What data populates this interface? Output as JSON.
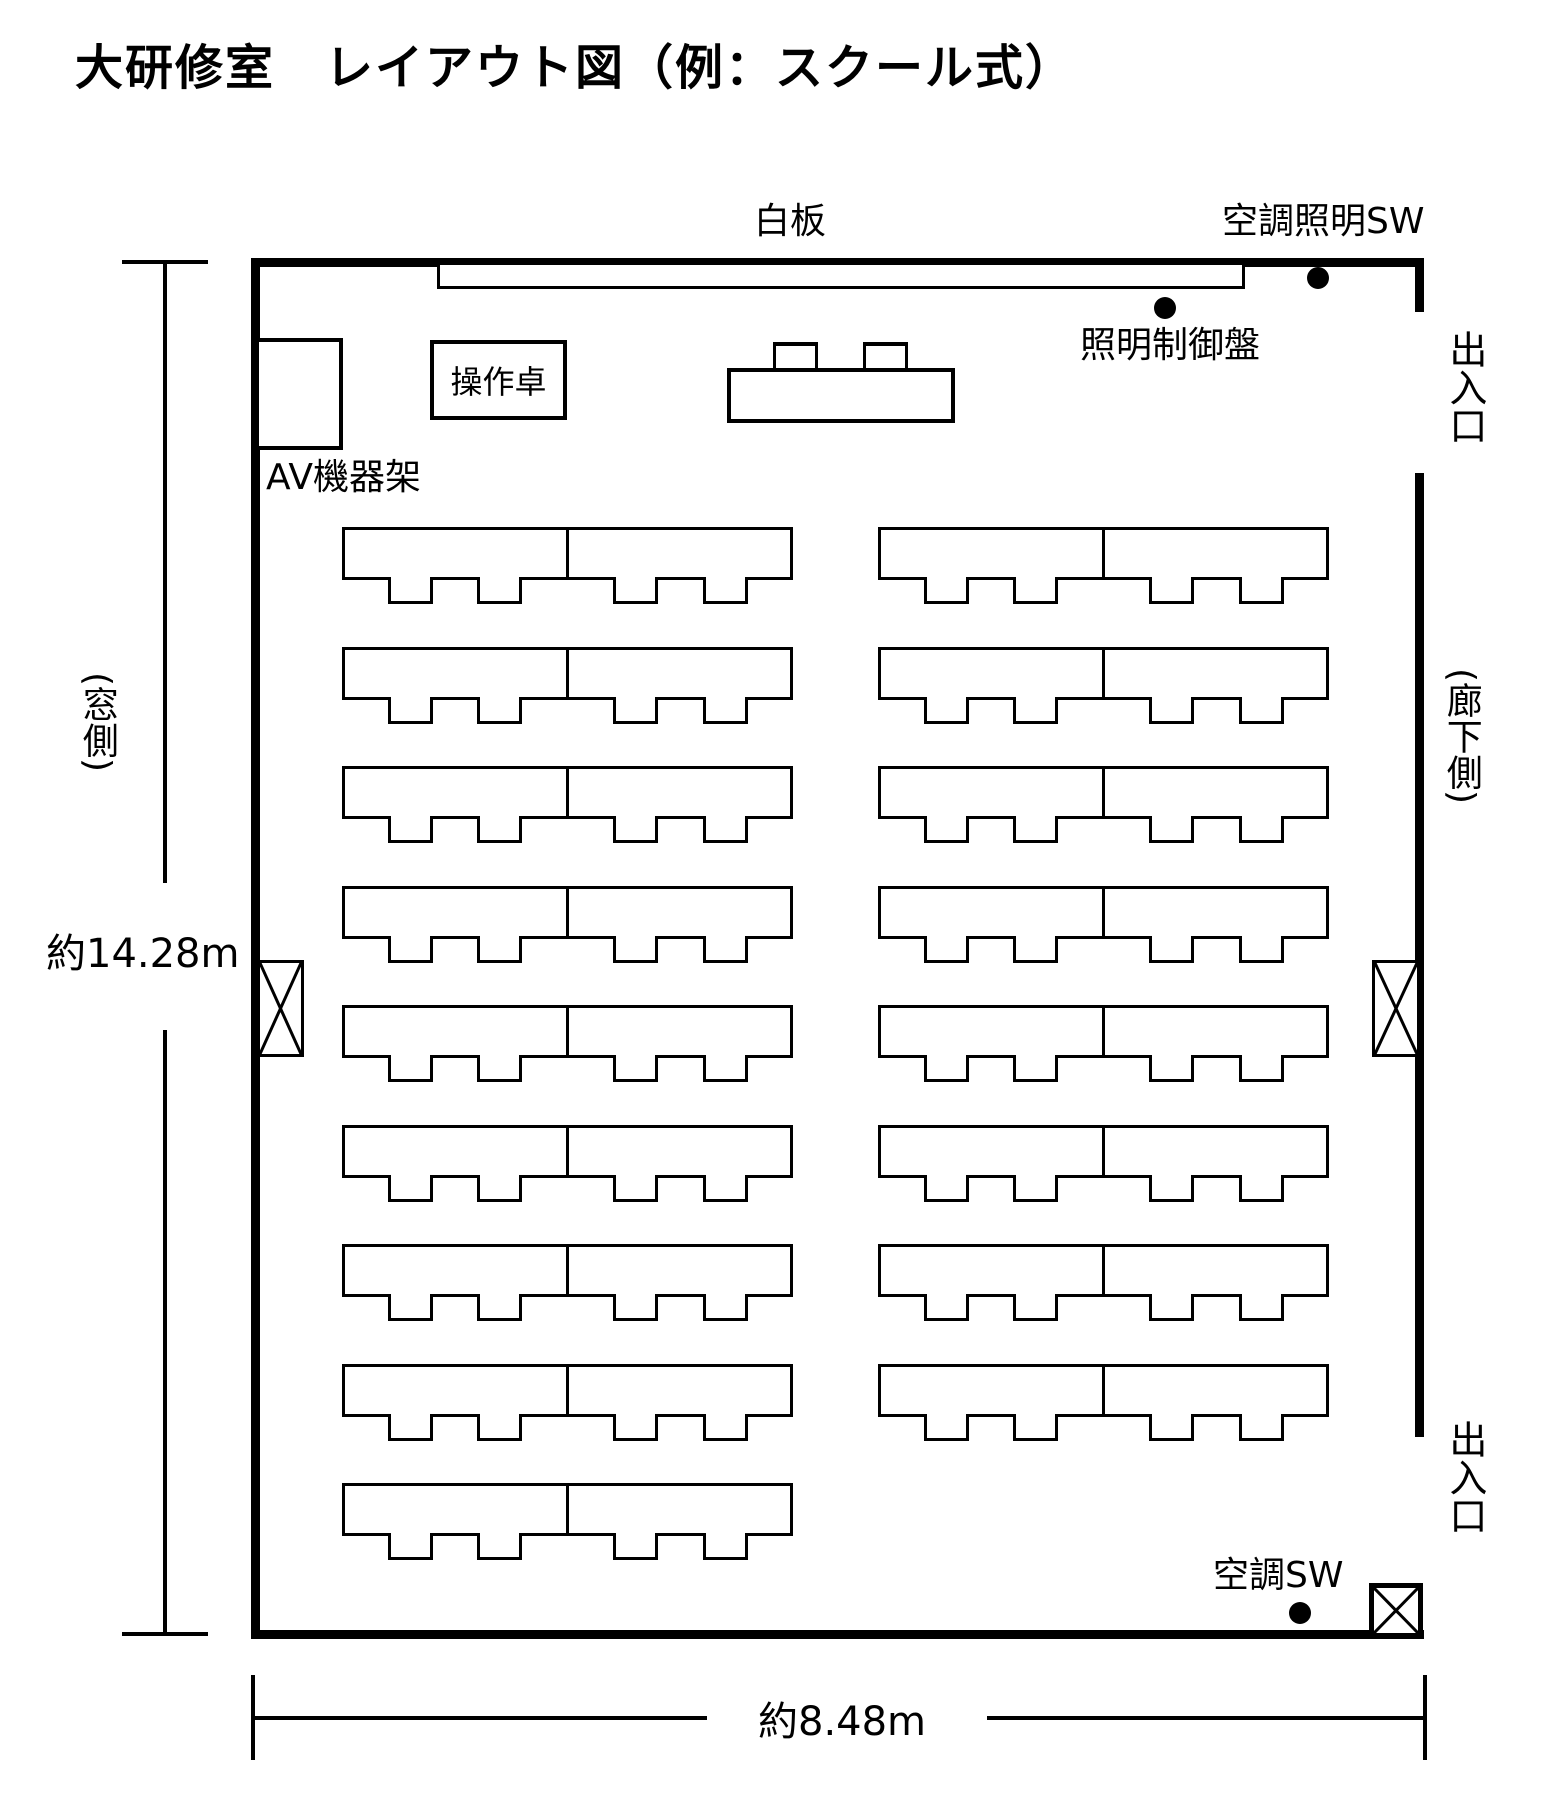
{
  "title": "大研修室　レイアウト図（例：スクール式）",
  "labels": {
    "whiteboard": "白板",
    "hvac_lighting_switch": "空調照明SW",
    "lighting_control_panel": "照明制御盤",
    "av_rack": "AV機器架",
    "control_console": "操作卓",
    "entrance_top": "出入口",
    "entrance_bottom": "出入口",
    "window_side": "(窓側)",
    "corridor_side": "(廊下側)",
    "hvac_switch": "空調SW"
  },
  "dimensions": {
    "room_depth": "約14.28m",
    "room_width": "約8.48m"
  },
  "colors": {
    "ink": "#000000",
    "background": "#ffffff"
  },
  "seating": {
    "description": "student tables, school style, 2 joined tables per row block, 2 chairs per table",
    "table_pair_width": 451,
    "table_pair_height": 53,
    "chair_width": 45,
    "chair_height": 27,
    "chair_offsets": [
      46,
      135,
      271,
      361
    ],
    "row_start_y": 527,
    "row_pitch": 119.5,
    "columns": [
      {
        "id": "left",
        "x": 342,
        "rows": 9
      },
      {
        "id": "right",
        "x": 878,
        "rows": 8
      }
    ]
  },
  "presenter": {
    "chair_count": 2
  }
}
